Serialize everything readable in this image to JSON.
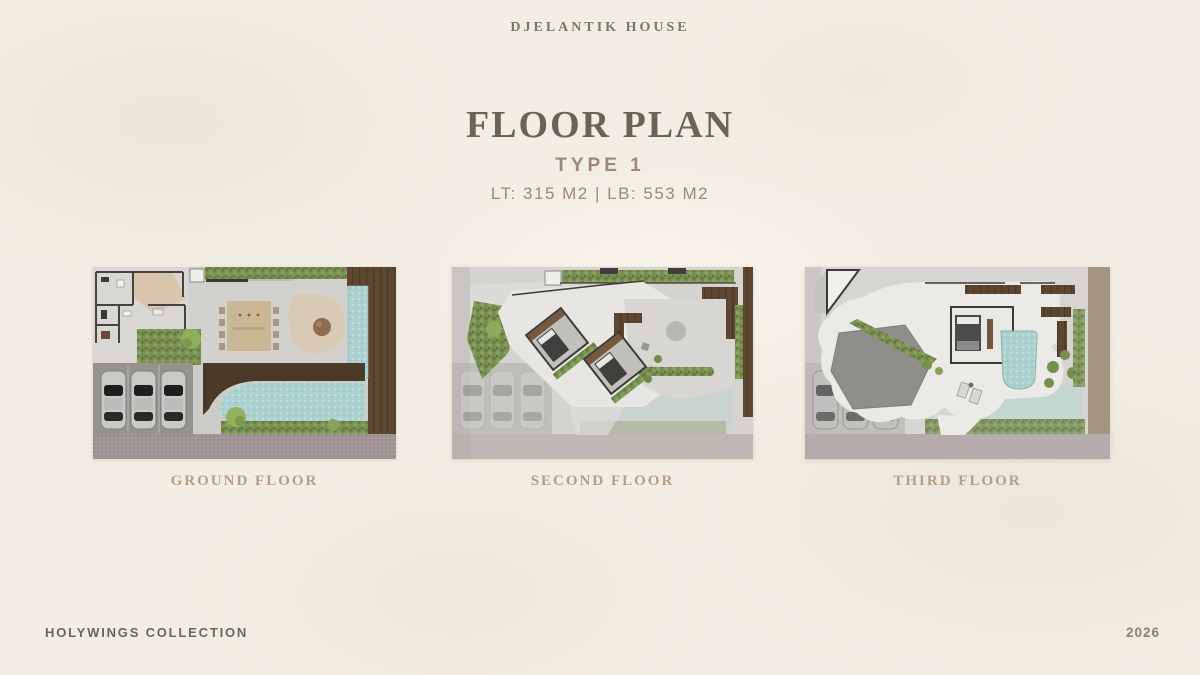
{
  "page": {
    "brand": "DJELANTIK HOUSE",
    "title": "FLOOR PLAN",
    "subtitle": "TYPE 1",
    "area_info": "LT: 315 M2 | LB: 553 M2"
  },
  "plans": [
    {
      "label": "GROUND FLOOR"
    },
    {
      "label": "SECOND FLOOR"
    },
    {
      "label": "THIRD FLOOR"
    }
  ],
  "footer": {
    "left": "HOLYWINGS COLLECTION",
    "right": "2026"
  },
  "colors": {
    "background": "#f3eee3",
    "title_text": "#6d6257",
    "accent_text": "#9d8876",
    "caption_text": "#b39e89",
    "footer_text": "#6b665c",
    "pool_teal": "#acd1d1",
    "hedge_green": "#7b9154",
    "wood_brown": "#5d4731",
    "floor_gray": "#ccccc8",
    "paver_mauve": "#a19494"
  }
}
